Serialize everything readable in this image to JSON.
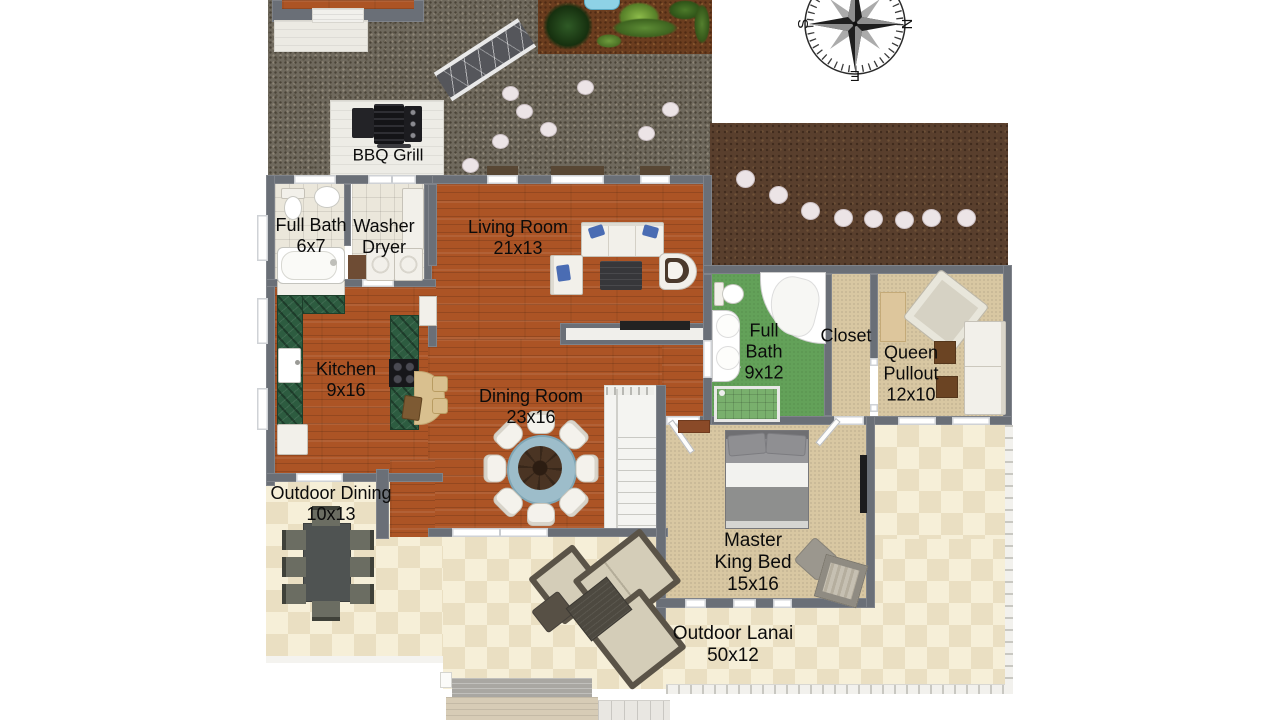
{
  "labels": {
    "bbq_grill": {
      "lines": [
        "BBQ Grill"
      ]
    },
    "full_bath_small": {
      "lines": [
        "Full Bath",
        "6x7"
      ]
    },
    "washer_dryer": {
      "lines": [
        "Washer",
        "Dryer"
      ]
    },
    "living_room": {
      "lines": [
        "Living Room",
        "21x13"
      ]
    },
    "kitchen": {
      "lines": [
        "Kitchen",
        "9x16"
      ]
    },
    "dining_room": {
      "lines": [
        "Dining Room",
        "23x16"
      ]
    },
    "full_bath_large": {
      "lines": [
        "Full",
        "Bath",
        "9x12"
      ]
    },
    "closet": {
      "lines": [
        "Closet"
      ]
    },
    "queen_pullout": {
      "lines": [
        "Queen",
        "Pullout",
        "12x10"
      ]
    },
    "outdoor_dining": {
      "lines": [
        "Outdoor Dining",
        "10x13"
      ]
    },
    "master_bedroom": {
      "lines": [
        "Master",
        "King Bed",
        "15x16"
      ]
    },
    "outdoor_lanai": {
      "lines": [
        "Outdoor Lanai",
        "50x12"
      ]
    }
  },
  "compass": {
    "north": "N",
    "east": "E",
    "south": "S",
    "west": "W"
  },
  "colors": {
    "wood": "#AC5425",
    "tile_light": "#F6EFD8",
    "tile_dark": "#EADFC2",
    "carpet": "#D8C7A2",
    "bath_green": "#63A159",
    "counter_green": "#2D5C40",
    "wall": "#6A6F77",
    "dirt": "#593F2D",
    "gravel": "#6F695D",
    "mulch": "#6B3D1F",
    "accent_pillow": "#4A6CB3",
    "table_ring": "#9DBDCA"
  }
}
